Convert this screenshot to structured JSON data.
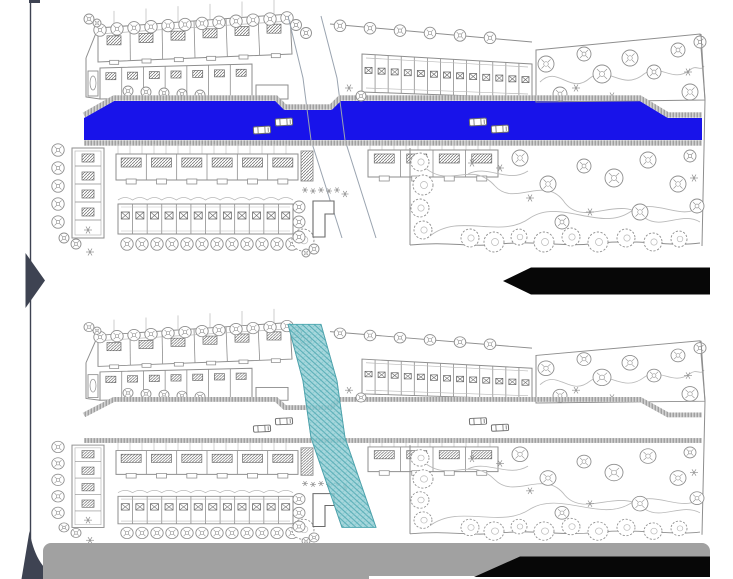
{
  "slide": {
    "background": "#ffffff",
    "description": "comparison of two architectural site plans, one above the other"
  },
  "colors": {
    "road_highlight_blue": "#1813ea",
    "corridor_teal_fill": "#93ced4",
    "corridor_teal_hatch": "#55acb5",
    "corridor_teal_edge": "#45a3ac",
    "plan_line": "#8e8e8e",
    "plan_line_dark": "#6a6a6a",
    "plan_line_light": "#b9b9b9",
    "corridor_guide_line": "#9aa4b0",
    "wall_base": "#d2d2d2",
    "wall_tick": "#8a8a8a",
    "footer_bar": "#a1a1a1",
    "redaction_ink": "#070707",
    "accent_navy": "#3e4352",
    "car_fill": "#ffffff",
    "car_line": "#6f6f6f"
  },
  "plans": {
    "top": {
      "name": "site-plan-top",
      "highlight": "solid blue road band across full width",
      "cars_on_road": 4
    },
    "bottom": {
      "name": "site-plan-bottom",
      "highlight": "teal hatched diagonal corridor band crossing the site",
      "cars_on_road": 4
    }
  },
  "annotations": {
    "left_chevron": {
      "direction": "right",
      "color": "#3e4352"
    },
    "guide_line": {
      "orientation": "vertical",
      "color": "#3e4352"
    },
    "corner_wedge": {
      "position": "bottom-left",
      "color": "#3e4352"
    },
    "top_plan_label": {
      "shape": "left-pointing black arrow (text redacted)",
      "color": "#070707"
    },
    "bottom_plan_label": {
      "shape": "left-pointing black banner (text redacted)",
      "color": "#070707"
    },
    "footer_bar": {
      "color": "#a1a1a1"
    }
  }
}
